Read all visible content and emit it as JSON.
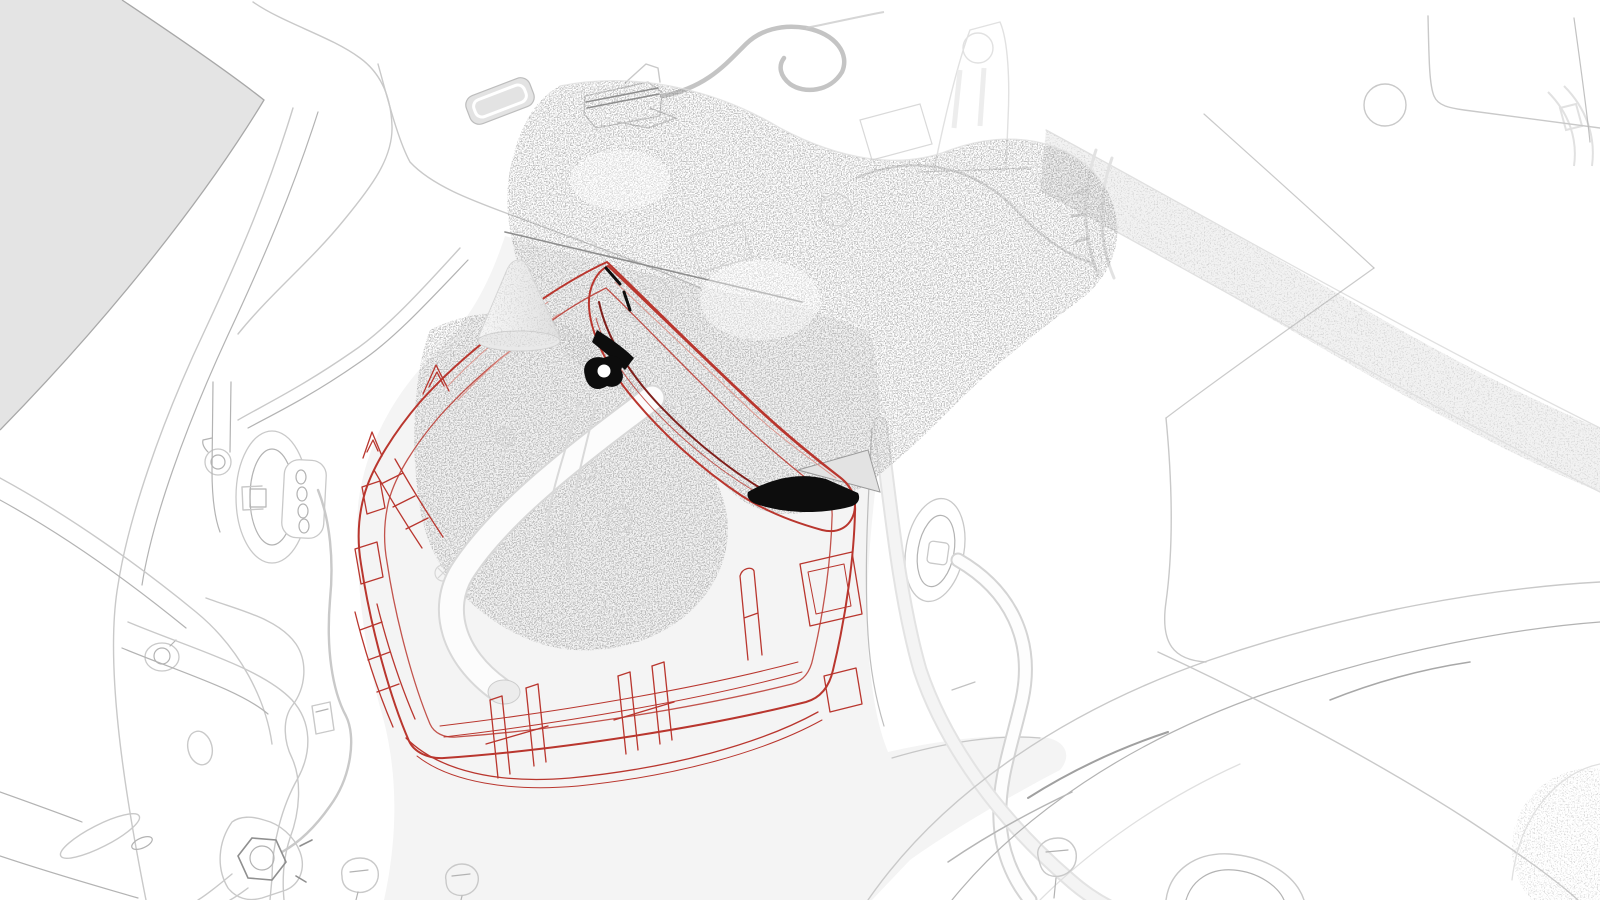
{
  "canvas": {
    "width": 1600,
    "height": 900,
    "background": "#ffffff"
  },
  "colors": {
    "line_light": "#c9c9c9",
    "line_medium": "#b3b3b3",
    "line_dark": "#8f8f8f",
    "highlight_red": "#b9362e",
    "highlight_red_dark": "#7f1f1b",
    "highlight_red_light": "#dc958d",
    "accent_black": "#0d0d0d",
    "shade_gray": "#e4e4e4",
    "panel_gray": "#f4f4f4",
    "tube_gray": "#f2f2f2",
    "stipple_gray": "#8f8f8f",
    "cone_gray": "#ececec"
  },
  "diagram": {
    "type": "technical-illustration",
    "parts": [
      {
        "name": "charge-port-housing-bracket",
        "highlighted": true,
        "color": "highlight_red"
      },
      {
        "name": "charge-port-door-pocket",
        "highlighted": true,
        "color": "highlight_red"
      },
      {
        "name": "bracket-retainer-clips",
        "highlighted": true,
        "color": "highlight_red"
      },
      {
        "name": "seal-contact-marks",
        "highlighted": false,
        "color": "accent_black"
      },
      {
        "name": "charge-port-assembly",
        "highlighted": false,
        "color": "stipple_gray"
      },
      {
        "name": "locating-cone",
        "highlighted": false,
        "color": "cone_gray"
      },
      {
        "name": "white-wiring-harness",
        "highlighted": false,
        "color": "line_light"
      },
      {
        "name": "quarter-glass-shade",
        "highlighted": false,
        "color": "shade_gray"
      },
      {
        "name": "inner-panel-region",
        "highlighted": false,
        "color": "panel_gray"
      },
      {
        "name": "hinge-striker-plate",
        "highlighted": false,
        "color": "line_light"
      },
      {
        "name": "body-grommet-with-cable",
        "highlighted": false,
        "color": "line_light"
      },
      {
        "name": "rear-rail-tube",
        "highlighted": false,
        "color": "tube_gray"
      },
      {
        "name": "hex-bolt-assembly",
        "highlighted": false,
        "color": "line_light"
      },
      {
        "name": "push-clips",
        "highlighted": false,
        "color": "line_light"
      },
      {
        "name": "wheel-arch-lines",
        "highlighted": false,
        "color": "line_light"
      }
    ]
  }
}
